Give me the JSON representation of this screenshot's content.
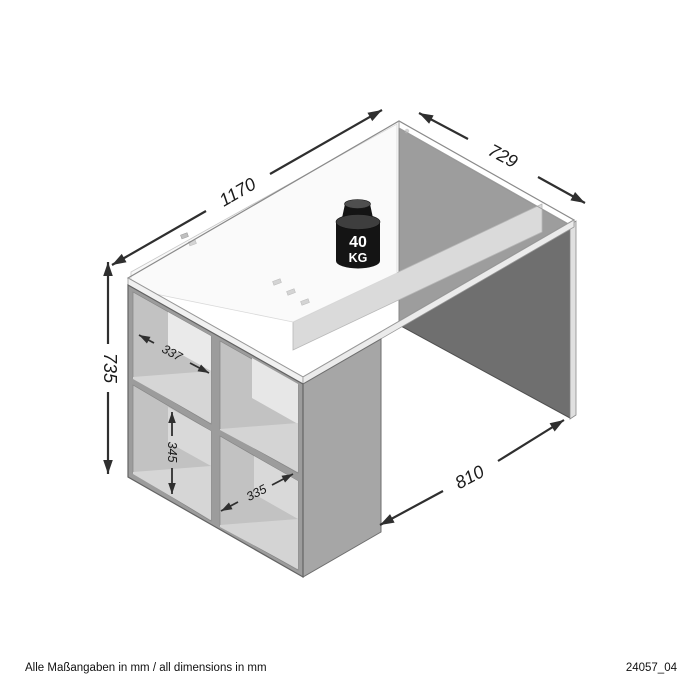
{
  "drawing": {
    "type": "furniture-dimension-diagram",
    "subject": "desk with side shelf compartments",
    "footer_note": "Alle Maßangaben in mm / all dimensions in mm",
    "drawing_number": "24057_04",
    "weight_capacity": {
      "value": "40",
      "unit": "KG"
    },
    "dimensions": {
      "length": "1170",
      "depth": "729",
      "height": "735",
      "knee_space_width": "810",
      "compartment_width_top": "337",
      "compartment_height": "345",
      "compartment_width_bottom": "335"
    },
    "colors": {
      "dimension_line": "#2f2f2f",
      "panel_dark": "#6f6f6f",
      "panel_mid": "#a6a6a6",
      "panel_light": "#f8f8f8",
      "weight_badge": "#141414"
    }
  }
}
